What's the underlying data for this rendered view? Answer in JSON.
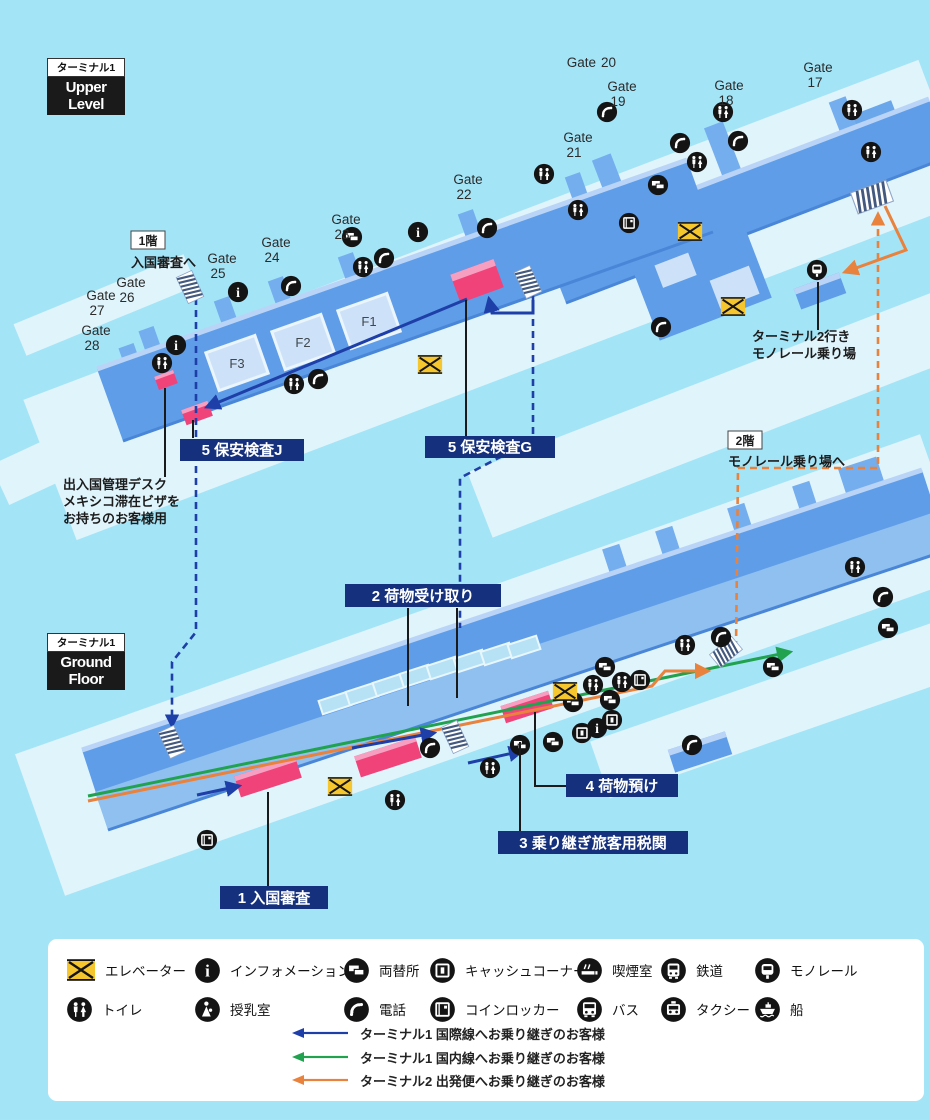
{
  "upper": {
    "tag": "ターミナル1",
    "title": "Upper Level",
    "gates": [
      {
        "word": "Gate",
        "number": "20"
      },
      {
        "word": "Gate",
        "number": "19"
      },
      {
        "word": "Gate",
        "number": "18"
      },
      {
        "word": "Gate",
        "number": "17"
      },
      {
        "word": "Gate",
        "number": "21"
      },
      {
        "word": "Gate",
        "number": "22"
      },
      {
        "word": "Gate",
        "number": "23"
      },
      {
        "word": "Gate",
        "number": "24"
      },
      {
        "word": "Gate",
        "number": "25"
      },
      {
        "word": "Gate",
        "number": "26"
      },
      {
        "word": "Gate",
        "number": "27"
      },
      {
        "word": "Gate",
        "number": "28"
      }
    ],
    "rooms": [
      {
        "label": "F1"
      },
      {
        "label": "F2"
      },
      {
        "label": "F3"
      }
    ],
    "to_ground": {
      "floor": "1階",
      "text": "入国審査へ"
    },
    "security_j": "5 保安検査J",
    "security_g": "5 保安検査G",
    "immigration_desk": {
      "line1": "出入国管理デスク",
      "line2": "メキシコ滞在ビザを",
      "line3": "お持ちのお客様用"
    },
    "monorail_t2": {
      "line1": "ターミナル2行き",
      "line2": "モノレール乗り場"
    },
    "to_monorail": {
      "floor": "2階",
      "text": "モノレール乗り場へ"
    }
  },
  "ground": {
    "tag": "ターミナル1",
    "title": "Ground Floor",
    "baggage_claim": "2 荷物受け取り",
    "baggage_drop": "4 荷物預け",
    "transfer_customs": "3 乗り継ぎ旅客用税関",
    "immigration": "1 入国審査"
  },
  "legend": {
    "facilities_row1": [
      {
        "icon": "elevator",
        "label": "エレベーター"
      },
      {
        "icon": "information",
        "label": "インフォメーション"
      },
      {
        "icon": "currency-exchange",
        "label": "両替所"
      },
      {
        "icon": "cash-corner",
        "label": "キャッシュコーナー"
      },
      {
        "icon": "smoking-room",
        "label": "喫煙室"
      },
      {
        "icon": "railway",
        "label": "鉄道"
      },
      {
        "icon": "monorail",
        "label": "モノレール"
      }
    ],
    "facilities_row2": [
      {
        "icon": "toilet",
        "label": "トイレ"
      },
      {
        "icon": "nursing-room",
        "label": "授乳室"
      },
      {
        "icon": "phone",
        "label": "電話"
      },
      {
        "icon": "coin-locker",
        "label": "コインロッカー"
      },
      {
        "icon": "bus",
        "label": "バス"
      },
      {
        "icon": "taxi",
        "label": "タクシー"
      },
      {
        "icon": "ship",
        "label": "船"
      }
    ],
    "routes": [
      {
        "color": "#1e3ea8",
        "label": "ターミナル1 国際線へお乗り継ぎのお客様"
      },
      {
        "color": "#21a24f",
        "label": "ターミナル1 国内線へお乗り継ぎのお客様"
      },
      {
        "color": "#e8823d",
        "label": "ターミナル2 出発便へお乗り継ぎのお客様"
      }
    ]
  },
  "colors": {
    "background": "#a4e4f7",
    "apron": "#e0f4fb",
    "building": "#5f9de8",
    "building_light": "#b9d4f6",
    "building_dark": "#4a86d8",
    "room": "#cde2f8",
    "highlight_pink": "#f0437a",
    "highlight_pink_top": "#f79fc0",
    "label_navy": "#15317e",
    "elevator_yellow": "#f5c62e",
    "route_international": "#1e3ea8",
    "route_domestic": "#21a24f",
    "route_terminal2": "#e8823d"
  }
}
